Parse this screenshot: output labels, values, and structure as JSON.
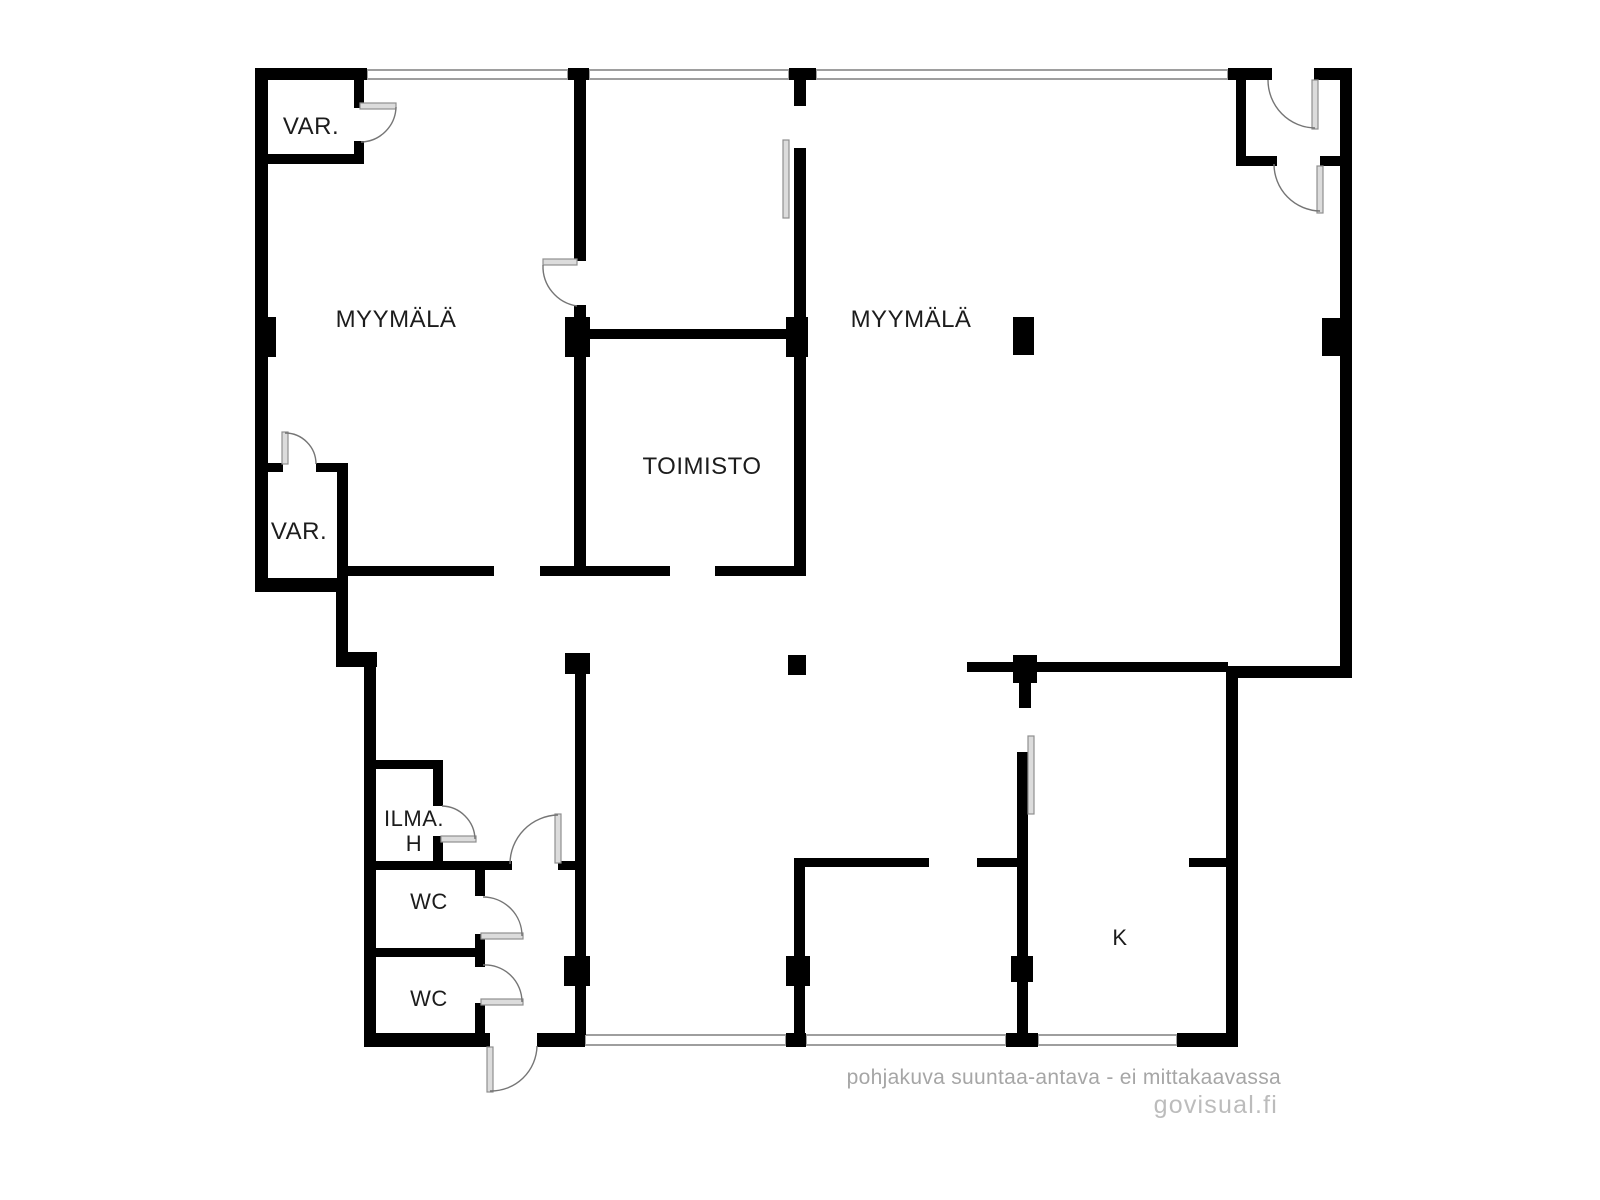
{
  "title": "Floor plan",
  "footer": {
    "disclaimer": "pohjakuva suuntaa-antava - ei mittakaavassa",
    "brand": "govisual.fi"
  },
  "colors": {
    "background": "#ffffff",
    "wall": "#000000",
    "window": "#9e9e9e",
    "door_arc": "#757575",
    "door_leaf_fill": "#dcdcdc",
    "door_leaf_stroke": "#8f8f8f",
    "label": "#1c1c1c",
    "disclaimer": "#a6a6a6",
    "brand": "#bcbcbc"
  },
  "plan": {
    "canvas": {
      "width": 1600,
      "height": 1200
    },
    "labels": [
      {
        "name": "room-label-var-1",
        "text": "VAR.",
        "x": 311,
        "y": 134,
        "size": 24
      },
      {
        "name": "room-label-myymala-left",
        "text": "MYYMÄLÄ",
        "x": 396,
        "y": 327,
        "size": 24
      },
      {
        "name": "room-label-myymala-right",
        "text": "MYYMÄLÄ",
        "x": 911,
        "y": 327,
        "size": 24
      },
      {
        "name": "room-label-toimisto",
        "text": "TOIMISTO",
        "x": 702,
        "y": 474,
        "size": 24
      },
      {
        "name": "room-label-var-2",
        "text": "VAR.",
        "x": 299,
        "y": 539,
        "size": 24
      },
      {
        "name": "room-label-ilma",
        "text": "ILMA.",
        "x": 414,
        "y": 826,
        "size": 22
      },
      {
        "name": "room-label-ilma-h",
        "text": "H",
        "x": 414,
        "y": 851,
        "size": 22
      },
      {
        "name": "room-label-wc-1",
        "text": "WC",
        "x": 429,
        "y": 909,
        "size": 22
      },
      {
        "name": "room-label-wc-2",
        "text": "WC",
        "x": 429,
        "y": 1006,
        "size": 22
      },
      {
        "name": "room-label-k",
        "text": "K",
        "x": 1120,
        "y": 945,
        "size": 22
      }
    ],
    "windows": [
      {
        "name": "top-window-1",
        "r": [
          367,
          70,
          201,
          9
        ]
      },
      {
        "name": "top-window-2",
        "r": [
          589,
          70,
          200,
          9
        ]
      },
      {
        "name": "top-window-3",
        "r": [
          816,
          70,
          412,
          9
        ]
      },
      {
        "name": "bottom-window-1",
        "r": [
          585,
          1035,
          201,
          10
        ]
      },
      {
        "name": "bottom-window-2",
        "r": [
          806,
          1035,
          200,
          10
        ]
      },
      {
        "name": "bottom-window-3",
        "r": [
          1038,
          1035,
          139,
          10
        ]
      }
    ],
    "walls": [
      {
        "name": "outer-top-wall-left",
        "r": [
          255,
          68,
          112,
          12
        ]
      },
      {
        "name": "top-window-pillar-1",
        "r": [
          568,
          68,
          21,
          12
        ]
      },
      {
        "name": "top-window-pillar-2",
        "r": [
          789,
          68,
          27,
          12
        ]
      },
      {
        "name": "partition-top-stub",
        "r": [
          794,
          80,
          12,
          26
        ]
      },
      {
        "name": "outer-top-wall-right-a",
        "r": [
          1228,
          68,
          44,
          12
        ]
      },
      {
        "name": "outer-top-wall-right-b",
        "r": [
          1314,
          68,
          38,
          12
        ]
      },
      {
        "name": "outer-right-wall",
        "r": [
          1340,
          68,
          12,
          610
        ]
      },
      {
        "name": "right-step-wall",
        "r": [
          1228,
          666,
          124,
          12
        ]
      },
      {
        "name": "lower-right-wall",
        "r": [
          1226,
          666,
          12,
          381
        ]
      },
      {
        "name": "bottom-right-corner-wall",
        "r": [
          1177,
          1033,
          61,
          14
        ]
      },
      {
        "name": "outer-left-wall",
        "r": [
          255,
          68,
          13,
          524
        ]
      },
      {
        "name": "var2-bottom-wall",
        "r": [
          255,
          578,
          92,
          14
        ]
      },
      {
        "name": "left-step-vertical-wall",
        "r": [
          336,
          578,
          12,
          82
        ]
      },
      {
        "name": "left-step-horizontal-wall",
        "r": [
          336,
          652,
          41,
          15
        ]
      },
      {
        "name": "lower-left-wall",
        "r": [
          364,
          652,
          12,
          395
        ]
      },
      {
        "name": "bottom-wall-left",
        "r": [
          364,
          1033,
          126,
          14
        ]
      },
      {
        "name": "bottom-wall-mid",
        "r": [
          537,
          1033,
          48,
          14
        ]
      },
      {
        "name": "var1-bottom-wall",
        "r": [
          262,
          154,
          102,
          10
        ]
      },
      {
        "name": "var1-right-wall-upper",
        "r": [
          354,
          80,
          10,
          28
        ]
      },
      {
        "name": "var1-right-wall-lower",
        "r": [
          354,
          141,
          10,
          23
        ]
      },
      {
        "name": "partition-wall-upper",
        "r": [
          574,
          80,
          12,
          181
        ]
      },
      {
        "name": "partition-wall-below-door",
        "r": [
          574,
          305,
          12,
          16
        ]
      },
      {
        "name": "pillar-toimisto-top-left",
        "r": [
          565,
          317,
          25,
          40
        ]
      },
      {
        "name": "toimisto-left-wall",
        "r": [
          574,
          357,
          12,
          214
        ]
      },
      {
        "name": "toimisto-top-wall",
        "r": [
          574,
          329,
          232,
          10
        ]
      },
      {
        "name": "pillar-toimisto-top-right",
        "r": [
          786,
          317,
          22,
          40
        ]
      },
      {
        "name": "toimisto-right-wall-upper",
        "r": [
          794,
          148,
          12,
          169
        ]
      },
      {
        "name": "toimisto-right-wall",
        "r": [
          794,
          357,
          12,
          214
        ]
      },
      {
        "name": "mid-wall-left",
        "r": [
          347,
          566,
          147,
          10
        ]
      },
      {
        "name": "mid-wall-center",
        "r": [
          540,
          566,
          130,
          10
        ]
      },
      {
        "name": "mid-wall-right",
        "r": [
          715,
          566,
          91,
          10
        ]
      },
      {
        "name": "pillar-left-wall",
        "r": [
          255,
          317,
          21,
          40
        ]
      },
      {
        "name": "pillar-right-wall",
        "r": [
          1322,
          318,
          18,
          38
        ]
      },
      {
        "name": "pillar-myymala-right",
        "r": [
          1013,
          317,
          21,
          38
        ]
      },
      {
        "name": "var2-top-wall-left",
        "r": [
          262,
          463,
          21,
          9
        ]
      },
      {
        "name": "var2-top-wall-right",
        "r": [
          316,
          463,
          31,
          9
        ]
      },
      {
        "name": "var2-right-wall",
        "r": [
          337,
          463,
          11,
          120
        ]
      },
      {
        "name": "mid-right-wall",
        "r": [
          967,
          662,
          261,
          10
        ]
      },
      {
        "name": "pillar-k-top",
        "r": [
          1013,
          655,
          24,
          28
        ]
      },
      {
        "name": "k-left-wall-stub",
        "r": [
          1019,
          683,
          12,
          25
        ]
      },
      {
        "name": "pillar-center-freestanding",
        "r": [
          788,
          655,
          18,
          20
        ]
      },
      {
        "name": "pillar-center-left",
        "r": [
          565,
          653,
          25,
          21
        ]
      },
      {
        "name": "center-wall-lower",
        "r": [
          575,
          674,
          11,
          361
        ]
      },
      {
        "name": "pillar-center-wall",
        "r": [
          564,
          956,
          26,
          30
        ]
      },
      {
        "name": "room-wall-x800",
        "r": [
          794,
          866,
          11,
          169
        ]
      },
      {
        "name": "pillar-x800",
        "r": [
          786,
          956,
          24,
          30
        ]
      },
      {
        "name": "hall-top-wall-left",
        "r": [
          794,
          858,
          135,
          9
        ]
      },
      {
        "name": "hall-top-wall-right",
        "r": [
          977,
          858,
          44,
          9
        ]
      },
      {
        "name": "k-left-wall",
        "r": [
          1017,
          752,
          11,
          283
        ]
      },
      {
        "name": "pillar-k-left",
        "r": [
          1011,
          956,
          22,
          26
        ]
      },
      {
        "name": "pillar-k-bottom",
        "r": [
          1006,
          1033,
          32,
          14
        ]
      },
      {
        "name": "pillar-x800-bottom",
        "r": [
          786,
          1033,
          20,
          14
        ]
      },
      {
        "name": "k-top-stub",
        "r": [
          1189,
          858,
          39,
          9
        ]
      },
      {
        "name": "vestibule-left-wall",
        "r": [
          1236,
          68,
          10,
          98
        ]
      },
      {
        "name": "vestibule-bottom-wall-left",
        "r": [
          1236,
          156,
          41,
          10
        ]
      },
      {
        "name": "vestibule-bottom-wall-right",
        "r": [
          1320,
          156,
          22,
          10
        ]
      },
      {
        "name": "ilmah-top-wall",
        "r": [
          364,
          760,
          78,
          9
        ]
      },
      {
        "name": "ilmah-right-wall-upper",
        "r": [
          433,
          760,
          10,
          46
        ]
      },
      {
        "name": "ilmah-right-wall-lower",
        "r": [
          433,
          836,
          10,
          32
        ]
      },
      {
        "name": "corridor-top-wall",
        "r": [
          364,
          861,
          148,
          9
        ]
      },
      {
        "name": "corridor-top-wall-right",
        "r": [
          558,
          861,
          28,
          9
        ]
      },
      {
        "name": "wc1-right-wall-upper",
        "r": [
          475,
          868,
          10,
          28
        ]
      },
      {
        "name": "wc1-right-wall-lower",
        "r": [
          475,
          934,
          10,
          33
        ]
      },
      {
        "name": "wc-divider-wall",
        "r": [
          364,
          948,
          115,
          9
        ]
      },
      {
        "name": "wc2-right-wall-lower",
        "r": [
          475,
          1003,
          10,
          32
        ]
      }
    ],
    "leaves": [
      {
        "name": "var1-door-leaf",
        "r": [
          360,
          103,
          36,
          6
        ]
      },
      {
        "name": "var2-door-leaf",
        "r": [
          282,
          432,
          6,
          32
        ]
      },
      {
        "name": "toimisto-door-leaf",
        "r": [
          543,
          259,
          34,
          6
        ]
      },
      {
        "name": "partition-sliding-leaf",
        "r": [
          783,
          140,
          6,
          78
        ]
      },
      {
        "name": "entrance-outer-door-leaf",
        "r": [
          1312,
          80,
          6,
          49
        ]
      },
      {
        "name": "entrance-inner-door-leaf",
        "r": [
          1317,
          166,
          6,
          47
        ]
      },
      {
        "name": "corridor-door-leaf",
        "r": [
          555,
          814,
          6,
          49
        ]
      },
      {
        "name": "ilmah-door-leaf",
        "r": [
          441,
          836,
          35,
          6
        ]
      },
      {
        "name": "wc1-door-leaf",
        "r": [
          481,
          933,
          42,
          6
        ]
      },
      {
        "name": "wc2-door-leaf",
        "r": [
          481,
          999,
          42,
          6
        ]
      },
      {
        "name": "exit-door-leaf",
        "r": [
          487,
          1047,
          6,
          45
        ]
      },
      {
        "name": "k-sliding-leaf",
        "r": [
          1028,
          736,
          6,
          78
        ]
      }
    ],
    "arcs": [
      {
        "name": "var1-door-arc",
        "x1": 396,
        "y1": 107,
        "r": 36,
        "x2": 361,
        "y2": 142,
        "sweep": 1
      },
      {
        "name": "var2-door-arc",
        "x1": 285,
        "y1": 433,
        "r": 31,
        "x2": 316,
        "y2": 464,
        "sweep": 1
      },
      {
        "name": "toimisto-door-arc",
        "x1": 543,
        "y1": 265,
        "r": 40,
        "x2": 577,
        "y2": 306,
        "sweep": 0
      },
      {
        "name": "entrance-outer-door-arc",
        "x1": 1268,
        "y1": 80,
        "r": 48,
        "x2": 1315,
        "y2": 128,
        "sweep": 0
      },
      {
        "name": "entrance-inner-door-arc",
        "x1": 1274,
        "y1": 164,
        "r": 47,
        "x2": 1320,
        "y2": 211,
        "sweep": 0
      },
      {
        "name": "corridor-door-arc",
        "x1": 558,
        "y1": 815,
        "r": 49,
        "x2": 510,
        "y2": 864,
        "sweep": 0
      },
      {
        "name": "ilmah-door-arc",
        "x1": 442,
        "y1": 806,
        "r": 34,
        "x2": 475,
        "y2": 839,
        "sweep": 1
      },
      {
        "name": "wc1-door-arc",
        "x1": 483,
        "y1": 897,
        "r": 39,
        "x2": 522,
        "y2": 936,
        "sweep": 1
      },
      {
        "name": "wc2-door-arc",
        "x1": 483,
        "y1": 965,
        "r": 37,
        "x2": 522,
        "y2": 1002,
        "sweep": 1
      },
      {
        "name": "exit-door-arc",
        "x1": 537,
        "y1": 1046,
        "r": 46,
        "x2": 490,
        "y2": 1091,
        "sweep": 1
      }
    ]
  }
}
